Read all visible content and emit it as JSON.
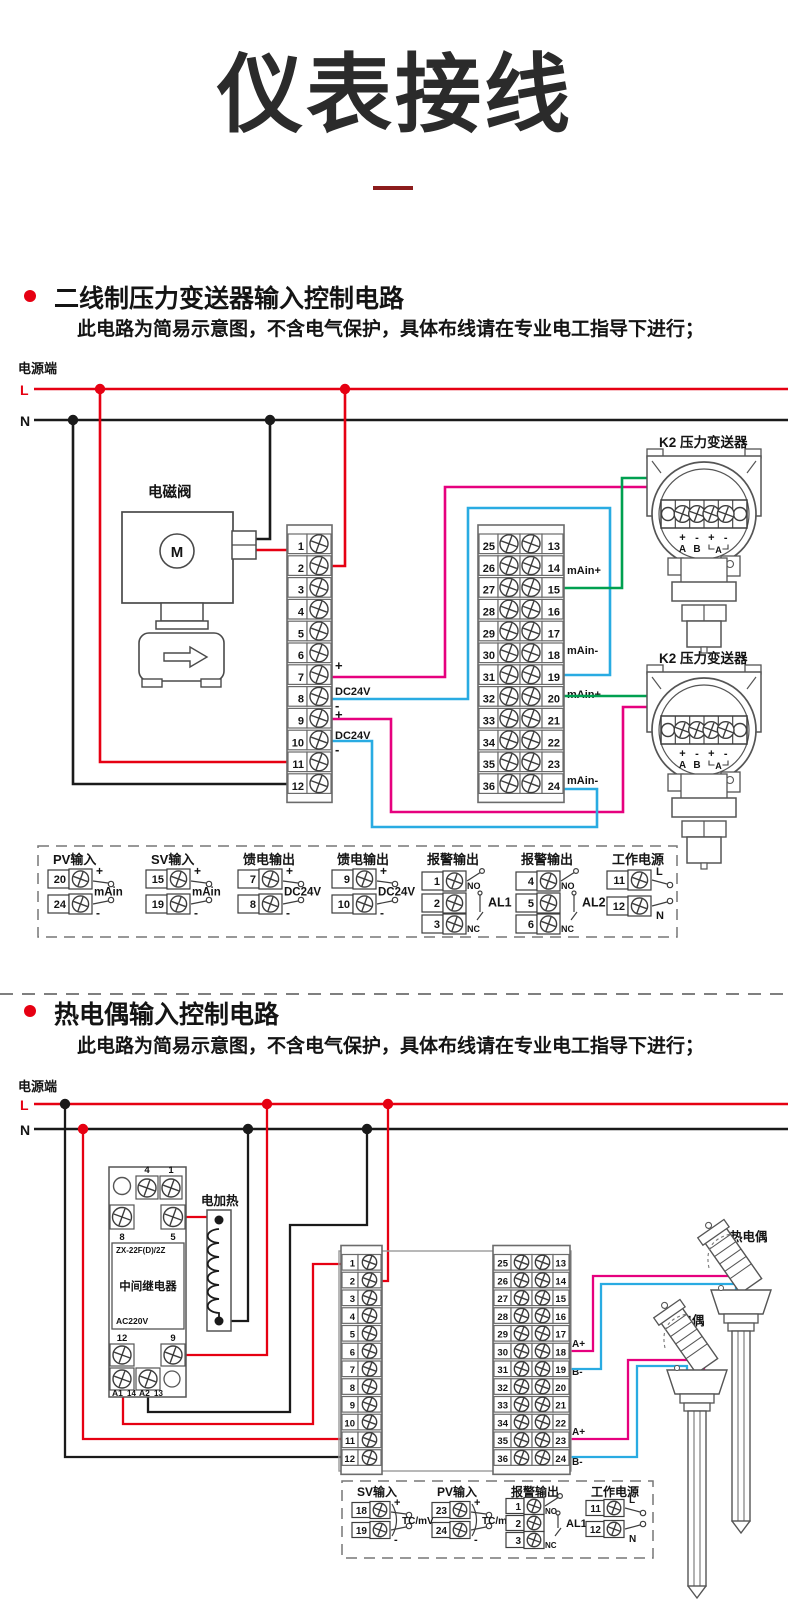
{
  "page": {
    "title": "仪表接线"
  },
  "colors": {
    "red": "#e60012",
    "line_black": "#1a1a1a",
    "magenta": "#e6007e",
    "green": "#00a050",
    "blue": "#29abe2",
    "outline": "#4d4d4d",
    "accent_dash": "#8c1c1c"
  },
  "section1": {
    "heading": "二线制压力变送器输入控制电路",
    "note": "此电路为简易示意图，不含电气保护，具体布线请在专业电工指导下进行；",
    "power_label": "电源端",
    "l_label": "L",
    "n_label": "N",
    "solenoid": {
      "label": "电磁阀",
      "motor": "M"
    },
    "strip_left_numbers": [
      1,
      2,
      3,
      4,
      5,
      6,
      7,
      8,
      9,
      10,
      11,
      12
    ],
    "strip_right_numbers_outer": [
      25,
      26,
      27,
      28,
      29,
      30,
      31,
      32,
      33,
      34,
      35,
      36
    ],
    "strip_right_numbers_inner": [
      13,
      14,
      15,
      16,
      17,
      18,
      19,
      20,
      21,
      22,
      23,
      24
    ],
    "feed_labels": [
      "+",
      "DC24V",
      "-",
      "+",
      "DC24V",
      "-"
    ],
    "current_labels": [
      "mAin+",
      "mAin-",
      "mAin+",
      "mAin-"
    ],
    "transmitters": [
      {
        "label": "K2 压力变送器"
      },
      {
        "label": "K2 压力变送器"
      }
    ],
    "transmitter_polarity": [
      "+",
      "-",
      "+",
      "-"
    ],
    "transmitter_pins": [
      "A",
      "B",
      "A"
    ],
    "legend": [
      {
        "title": "PV输入",
        "type": "io",
        "terminals": [
          {
            "no": "20",
            "tag": "+"
          },
          {
            "no": "24",
            "tag": "-"
          }
        ],
        "label": "mAin"
      },
      {
        "title": "SV输入",
        "type": "io",
        "terminals": [
          {
            "no": "15",
            "tag": "+"
          },
          {
            "no": "19",
            "tag": "-"
          }
        ],
        "label": "mAin"
      },
      {
        "title": "馈电输出",
        "type": "io",
        "terminals": [
          {
            "no": "7",
            "tag": "+"
          },
          {
            "no": "8",
            "tag": "-"
          }
        ],
        "label": "DC24V"
      },
      {
        "title": "馈电输出",
        "type": "io",
        "terminals": [
          {
            "no": "9",
            "tag": "+"
          },
          {
            "no": "10",
            "tag": "-"
          }
        ],
        "label": "DC24V"
      },
      {
        "title": "报警输出",
        "type": "alarm",
        "terminals": [
          {
            "no": "1",
            "tag": "NO"
          },
          {
            "no": "2",
            "tag": ""
          },
          {
            "no": "3",
            "tag": "NC"
          }
        ],
        "label": "AL1"
      },
      {
        "title": "报警输出",
        "type": "alarm",
        "terminals": [
          {
            "no": "4",
            "tag": "NO"
          },
          {
            "no": "5",
            "tag": ""
          },
          {
            "no": "6",
            "tag": "NC"
          }
        ],
        "label": "AL2"
      },
      {
        "title": "工作电源",
        "type": "power",
        "terminals": [
          {
            "no": "11",
            "tag": "L"
          },
          {
            "no": "12",
            "tag": "N"
          }
        ],
        "label": ""
      }
    ]
  },
  "section2": {
    "heading": "热电偶输入控制电路",
    "note": "此电路为简易示意图，不含电气保护，具体布线请在专业电工指导下进行；",
    "power_label": "电源端",
    "l_label": "L",
    "n_label": "N",
    "relay": {
      "model": "ZX-22F(D)/2Z",
      "name": "中间继电器",
      "voltage": "AC220V",
      "top_terminals": [
        "4",
        "1"
      ],
      "upper_terminals": [
        "8",
        "5"
      ],
      "lower_terminals": [
        "12",
        "9"
      ],
      "bottom_terminals": [
        "A1",
        "14",
        "A2",
        "13"
      ]
    },
    "heater_label": "电加热",
    "thermocouples": [
      {
        "label": "热电偶"
      },
      {
        "label": "热电偶"
      }
    ],
    "strip_left_numbers": [
      1,
      2,
      3,
      4,
      5,
      6,
      7,
      8,
      9,
      10,
      11,
      12
    ],
    "strip_right_numbers_outer": [
      25,
      26,
      27,
      28,
      29,
      30,
      31,
      32,
      33,
      34,
      35,
      36
    ],
    "strip_right_numbers_inner": [
      13,
      14,
      15,
      16,
      17,
      18,
      19,
      20,
      21,
      22,
      23,
      24
    ],
    "tc_signal_labels": [
      "A+",
      "B-",
      "A+",
      "B-"
    ],
    "legend": [
      {
        "title": "SV输入",
        "type": "io",
        "terminals": [
          {
            "no": "18",
            "tag": "+"
          },
          {
            "no": "19",
            "tag": "-"
          }
        ],
        "label": "TC/mV"
      },
      {
        "title": "PV输入",
        "type": "io",
        "terminals": [
          {
            "no": "23",
            "tag": "+"
          },
          {
            "no": "24",
            "tag": "-"
          }
        ],
        "label": "TC/mV"
      },
      {
        "title": "报警输出",
        "type": "alarm",
        "terminals": [
          {
            "no": "1",
            "tag": "NO"
          },
          {
            "no": "2",
            "tag": ""
          },
          {
            "no": "3",
            "tag": "NC"
          }
        ],
        "label": "AL1"
      },
      {
        "title": "工作电源",
        "type": "power",
        "terminals": [
          {
            "no": "11",
            "tag": "L"
          },
          {
            "no": "12",
            "tag": "N"
          }
        ],
        "label": ""
      }
    ]
  }
}
